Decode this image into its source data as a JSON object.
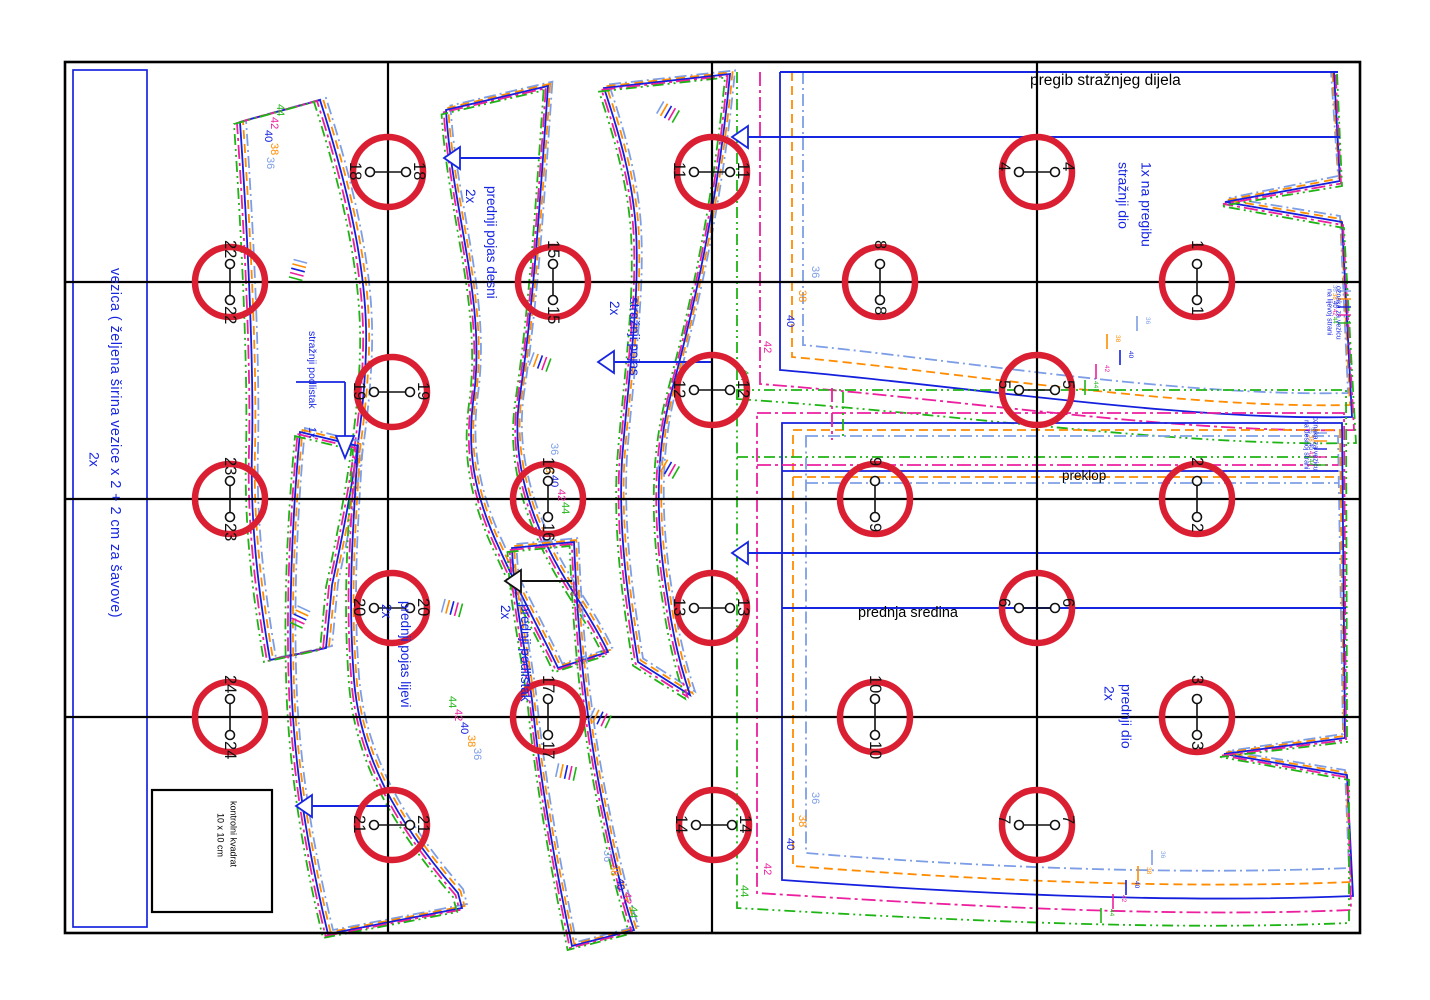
{
  "colors": {
    "marker_red": "#da1f33",
    "accent_blue": "#1726e0",
    "line_black": "#000000"
  },
  "sizes": [
    {
      "label": "36",
      "color": "#7d9ee6",
      "dash": "12 4 2 4"
    },
    {
      "label": "38",
      "color": "#ff8c00",
      "dash": "9 5"
    },
    {
      "label": "40",
      "color": "#1420dd",
      "dash": ""
    },
    {
      "label": "42",
      "color": "#ec1f9e",
      "dash": "14 4 3 4"
    },
    {
      "label": "44",
      "color": "#1eb414",
      "dash": "11 4 2 4 2 4"
    }
  ],
  "pieces": {
    "vezica": {
      "name": "vezica ( željena širina vezice x 2 + 2 cm za šavove)",
      "qty": "2x"
    },
    "straznji_podlistak": {
      "name": "stražnji podlistak",
      "qty": "1x"
    },
    "prednji_pojas_desni": {
      "name": "prednji pojas desni",
      "qty": "2x"
    },
    "straznji_pojas": {
      "name": "stražnji pojas",
      "qty": "2x"
    },
    "prednji_pojas_lijevi": {
      "name": "prednji pojas lijevi",
      "qty": "2x"
    },
    "prednji_podlistak": {
      "name": "prednji podlistak",
      "qty": "2x"
    },
    "straznji_dio": {
      "name": "stražnji dio",
      "qty": "1x na pregibu"
    },
    "prednji_dio": {
      "name": "prednji dio",
      "qty": "2x"
    }
  },
  "annotations": {
    "fold_back": "pregib stražnjeg dijela",
    "overlap": "preklop",
    "front_center": "prednja sredina",
    "control_square_line1": "kontrolni kvadrat",
    "control_square_line2": "10 x 10 cm",
    "tie_mark_left_l1": "oznaka za vezicu",
    "tie_mark_left_l2": "na lijevoj strani",
    "tie_mark_right_l1": "oznaka za vezicu",
    "tie_mark_right_l2": "na desnoj strani"
  },
  "markers": [
    {
      "n": "1",
      "x": 1197,
      "y": 282,
      "o": "v"
    },
    {
      "n": "2",
      "x": 1197,
      "y": 499,
      "o": "v"
    },
    {
      "n": "3",
      "x": 1197,
      "y": 717,
      "o": "v"
    },
    {
      "n": "4",
      "x": 1037,
      "y": 172,
      "o": "h"
    },
    {
      "n": "5",
      "x": 1037,
      "y": 390,
      "o": "h"
    },
    {
      "n": "6",
      "x": 1037,
      "y": 608,
      "o": "h"
    },
    {
      "n": "7",
      "x": 1037,
      "y": 825,
      "o": "h"
    },
    {
      "n": "8",
      "x": 880,
      "y": 282,
      "o": "v"
    },
    {
      "n": "9",
      "x": 875,
      "y": 499,
      "o": "v"
    },
    {
      "n": "10",
      "x": 875,
      "y": 717,
      "o": "v"
    },
    {
      "n": "11",
      "x": 712,
      "y": 172,
      "o": "h"
    },
    {
      "n": "12",
      "x": 712,
      "y": 390,
      "o": "h"
    },
    {
      "n": "13",
      "x": 712,
      "y": 608,
      "o": "h"
    },
    {
      "n": "14",
      "x": 714,
      "y": 825,
      "o": "h"
    },
    {
      "n": "15",
      "x": 553,
      "y": 282,
      "o": "v"
    },
    {
      "n": "16",
      "x": 548,
      "y": 499,
      "o": "v"
    },
    {
      "n": "17",
      "x": 548,
      "y": 717,
      "o": "v"
    },
    {
      "n": "18",
      "x": 388,
      "y": 172,
      "o": "h"
    },
    {
      "n": "19",
      "x": 392,
      "y": 392,
      "o": "h"
    },
    {
      "n": "20",
      "x": 392,
      "y": 608,
      "o": "h"
    },
    {
      "n": "21",
      "x": 392,
      "y": 825,
      "o": "h"
    },
    {
      "n": "22",
      "x": 230,
      "y": 282,
      "o": "v"
    },
    {
      "n": "23",
      "x": 230,
      "y": 499,
      "o": "v"
    },
    {
      "n": "24",
      "x": 230,
      "y": 717,
      "o": "v"
    }
  ],
  "size_labels": [
    {
      "s": 0,
      "x": 812,
      "y": 266
    },
    {
      "s": 1,
      "x": 799,
      "y": 290
    },
    {
      "s": 2,
      "x": 787,
      "y": 315
    },
    {
      "s": 3,
      "x": 764,
      "y": 341
    },
    {
      "s": 4,
      "x": 741,
      "y": 369
    },
    {
      "s": 0,
      "x": 812,
      "y": 792
    },
    {
      "s": 1,
      "x": 799,
      "y": 815
    },
    {
      "s": 2,
      "x": 787,
      "y": 838
    },
    {
      "s": 3,
      "x": 764,
      "y": 863
    },
    {
      "s": 4,
      "x": 741,
      "y": 885
    },
    {
      "s": 4,
      "x": 277,
      "y": 104
    },
    {
      "s": 3,
      "x": 271,
      "y": 117
    },
    {
      "s": 2,
      "x": 265,
      "y": 130
    },
    {
      "s": 1,
      "x": 271,
      "y": 143
    },
    {
      "s": 0,
      "x": 267,
      "y": 157
    },
    {
      "s": 0,
      "x": 551,
      "y": 443
    },
    {
      "s": 1,
      "x": 546,
      "y": 461
    },
    {
      "s": 2,
      "x": 551,
      "y": 475
    },
    {
      "s": 3,
      "x": 558,
      "y": 489
    },
    {
      "s": 4,
      "x": 562,
      "y": 502
    },
    {
      "s": 0,
      "x": 604,
      "y": 850
    },
    {
      "s": 1,
      "x": 611,
      "y": 864
    },
    {
      "s": 2,
      "x": 617,
      "y": 878
    },
    {
      "s": 3,
      "x": 624,
      "y": 892
    },
    {
      "s": 4,
      "x": 630,
      "y": 906
    },
    {
      "s": 4,
      "x": 449,
      "y": 696
    },
    {
      "s": 3,
      "x": 455,
      "y": 709
    },
    {
      "s": 2,
      "x": 461,
      "y": 722
    },
    {
      "s": 1,
      "x": 468,
      "y": 735
    },
    {
      "s": 0,
      "x": 474,
      "y": 748
    }
  ],
  "hem_ticks": [
    {
      "s": 0,
      "x": 1137,
      "y": 316
    },
    {
      "s": 1,
      "x": 1107,
      "y": 334
    },
    {
      "s": 2,
      "x": 1120,
      "y": 350
    },
    {
      "s": 3,
      "x": 1096,
      "y": 364
    },
    {
      "s": 4,
      "x": 1085,
      "y": 380
    },
    {
      "s": 0,
      "x": 1152,
      "y": 850
    },
    {
      "s": 1,
      "x": 1138,
      "y": 866
    },
    {
      "s": 2,
      "x": 1126,
      "y": 880
    },
    {
      "s": 3,
      "x": 1113,
      "y": 894
    },
    {
      "s": 4,
      "x": 1101,
      "y": 908
    }
  ],
  "oznaka_ticks": [
    {
      "s": 0,
      "x": 1338,
      "y": 291
    },
    {
      "s": 1,
      "x": 1338,
      "y": 299
    },
    {
      "s": 2,
      "x": 1338,
      "y": 307
    },
    {
      "s": 3,
      "x": 1338,
      "y": 315
    },
    {
      "s": 4,
      "x": 1338,
      "y": 323
    },
    {
      "s": 0,
      "x": 1314,
      "y": 433
    },
    {
      "s": 1,
      "x": 1314,
      "y": 441
    },
    {
      "s": 2,
      "x": 1314,
      "y": 449
    },
    {
      "s": 3,
      "x": 1314,
      "y": 457
    },
    {
      "s": 4,
      "x": 1314,
      "y": 465
    }
  ],
  "notches": [
    {
      "x": 540,
      "y": 362,
      "a": -70
    },
    {
      "x": 600,
      "y": 718,
      "a": -65
    },
    {
      "x": 668,
      "y": 112,
      "a": -60
    },
    {
      "x": 668,
      "y": 468,
      "a": -60
    },
    {
      "x": 452,
      "y": 608,
      "a": -75
    },
    {
      "x": 566,
      "y": 772,
      "a": -78
    },
    {
      "x": 300,
      "y": 617,
      "a": 25
    },
    {
      "x": 298,
      "y": 270,
      "a": 15
    }
  ]
}
